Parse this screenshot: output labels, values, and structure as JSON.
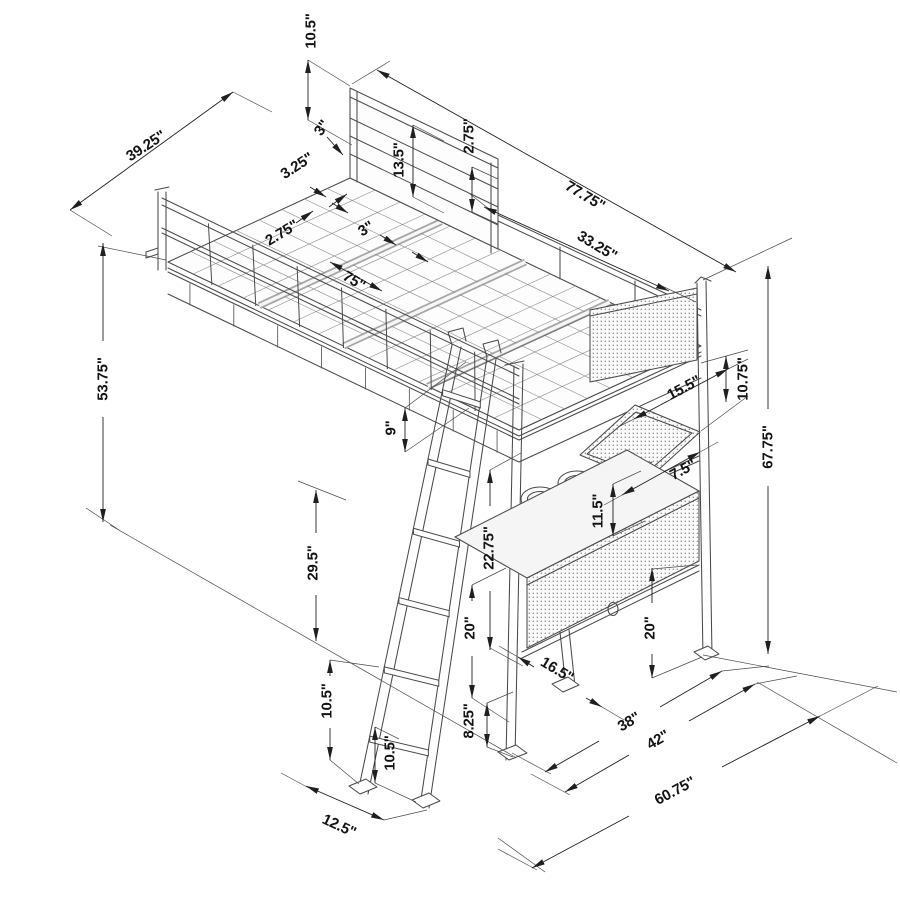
{
  "drawing": {
    "type": "isometric-dimension-diagram",
    "subject": "loft bed frame with guard rails, ladder, shelf and desk",
    "colors": {
      "background": "#ffffff",
      "structure_line": "#4a4a4a",
      "dimension_line": "#1f1f1f",
      "label_text": "#141414",
      "mesh_dot": "#8f8f8f",
      "surface_fill": "#f5f5f5"
    },
    "dimensions": [
      {
        "label": "10.5\"",
        "x": 311,
        "y": 31,
        "rot": -90
      },
      {
        "label": "3\"",
        "x": 322,
        "y": 128,
        "rot": -55
      },
      {
        "label": "39.25\"",
        "x": 146,
        "y": 146,
        "rot": -33
      },
      {
        "label": "3.25\"",
        "x": 297,
        "y": 166,
        "rot": -33
      },
      {
        "label": "13.5\"",
        "x": 399,
        "y": 160,
        "rot": -90
      },
      {
        "label": "2.75\"",
        "x": 469,
        "y": 136,
        "rot": -90
      },
      {
        "label": "77.75\"",
        "x": 585,
        "y": 196,
        "rot": 31
      },
      {
        "label": "33.25\"",
        "x": 597,
        "y": 246,
        "rot": 31
      },
      {
        "label": "2.75\"",
        "x": 282,
        "y": 233,
        "rot": -31
      },
      {
        "label": "3\"",
        "x": 366,
        "y": 229,
        "rot": -31
      },
      {
        "label": "75\"",
        "x": 354,
        "y": 281,
        "rot": 31
      },
      {
        "label": "53.75\"",
        "x": 103,
        "y": 379,
        "rot": -90
      },
      {
        "label": "9\"",
        "x": 391,
        "y": 428,
        "rot": -90
      },
      {
        "label": "15.5\"",
        "x": 684,
        "y": 388,
        "rot": -28
      },
      {
        "label": "10.75\"",
        "x": 743,
        "y": 379,
        "rot": -90
      },
      {
        "label": "67.75\"",
        "x": 768,
        "y": 447,
        "rot": -90
      },
      {
        "label": "7.5\"",
        "x": 683,
        "y": 470,
        "rot": -28
      },
      {
        "label": "11.5\"",
        "x": 598,
        "y": 511,
        "rot": -90
      },
      {
        "label": "22.75\"",
        "x": 489,
        "y": 548,
        "rot": -90
      },
      {
        "label": "29.5\"",
        "x": 313,
        "y": 563,
        "rot": -90
      },
      {
        "label": "20\"",
        "x": 470,
        "y": 628,
        "rot": -90
      },
      {
        "label": "20\"",
        "x": 650,
        "y": 628,
        "rot": -90
      },
      {
        "label": "16.5\"",
        "x": 557,
        "y": 670,
        "rot": 31
      },
      {
        "label": "10.5\"",
        "x": 327,
        "y": 701,
        "rot": -90
      },
      {
        "label": "38\"",
        "x": 629,
        "y": 722,
        "rot": -30
      },
      {
        "label": "42\"",
        "x": 658,
        "y": 740,
        "rot": -30
      },
      {
        "label": "8.25\"",
        "x": 469,
        "y": 721,
        "rot": -90
      },
      {
        "label": "10.5\"",
        "x": 390,
        "y": 753,
        "rot": -90
      },
      {
        "label": "60.75\"",
        "x": 675,
        "y": 791,
        "rot": -28
      },
      {
        "label": "12.5\"",
        "x": 339,
        "y": 826,
        "rot": 25
      }
    ]
  }
}
